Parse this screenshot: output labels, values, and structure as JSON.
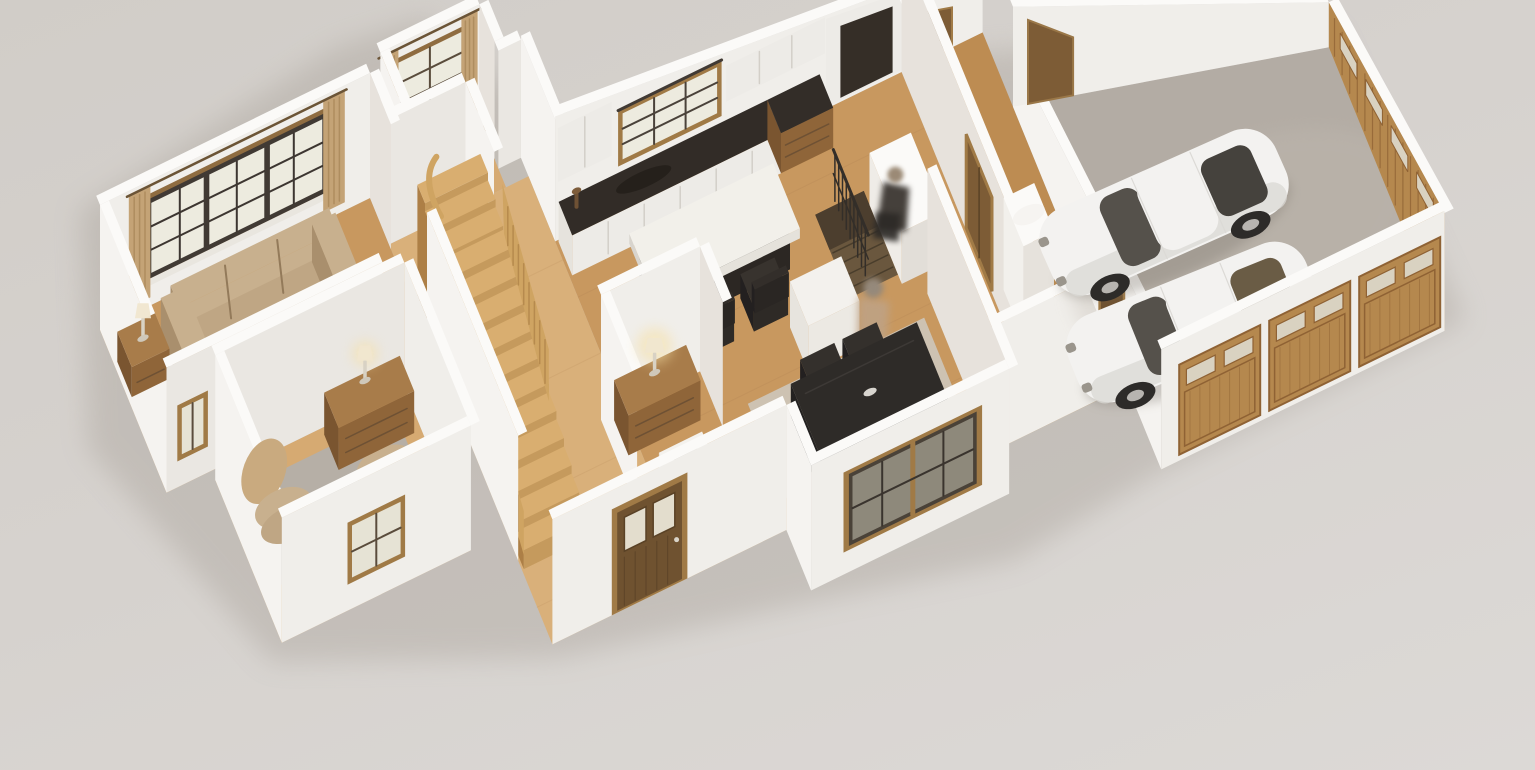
{
  "scene": {
    "description": "3D isometric cutaway floor-plan render of a single-story house model with furnished rooms and an attached two-car garage, viewed from above at an angle on a neutral light-gray ground",
    "view": "isometric dollhouse cutaway, no roof, white cut walls",
    "palette": {
      "ground1": "#d2cec9",
      "ground2": "#dcd9d6",
      "shadow": "#a8a199",
      "wallFace": "#f0eeea",
      "wallBright": "#f5f3f0",
      "wallShade": "#eae7e2",
      "wallInner": "#e7e2dc",
      "wallCap": "#fbfaf8",
      "floorWood": "#c8985f",
      "floorWoodLight": "#d6aa72",
      "floorWoodPale": "#d9b07a",
      "floorWoodDark": "#bd8c52",
      "rug": "#b6afa6",
      "rugWarm": "#cdc6bb",
      "garageFloor": "#b3aca4",
      "garageFloorLight": "#c2bbb2",
      "counterTop": "#322c27",
      "cabinet": "#edebe7",
      "cabinetLine": "#d3cfc8",
      "woodFurn": "#a87c4a",
      "woodFurnFront": "#8f6539",
      "woodFurnSide": "#7a5530",
      "stairTop": "#d9ae70",
      "stairRiser": "#c59a5d",
      "stairSide": "#ad7f46",
      "balustrade": "#cfa462",
      "balusterLine": "#b68a4e",
      "sofa": "#c8b08e",
      "sofaSeat": "#bfa684",
      "sofaShade": "#a98f6d",
      "sofaLine": "#937a5a",
      "curtain": "#c4a376",
      "curtainShade": "#a9875a",
      "curtainRod": "#6b5436",
      "frameDark": "#413a34",
      "frameWood": "#8f6c40",
      "frameWoodLight": "#a07a46",
      "glass": "#edebdf",
      "glassPane": "#e6e3d5",
      "glassDark": "#8e897b",
      "doorBrown": "#6f5230",
      "doorBrown2": "#7d5c36",
      "doorGlass": "#e3ddcd",
      "garageDoor": "#b5884e",
      "garageDoorLine": "#8f6234",
      "garageDoorGlass": "#d9d2c1",
      "tableBlack": "#2e2b28",
      "tableBlackSide": "#201e1c",
      "carBody": "#f3f2f0",
      "carShade": "#dad8d4",
      "carGlass": "#55514b",
      "carWheel": "#2d2b29",
      "carHub": "#b7b4b0",
      "carSunroof2": "#6a5c45",
      "donut": "#ecc99c",
      "donutShade": "#d6b07c",
      "donutHole": "#bb9260",
      "lampGlow": "#f6e0a6",
      "lampShade": "#f0e6cf",
      "lampBase": "#d8d2c4",
      "figureDark": "#45403b",
      "figureHead": "#9b8a76",
      "figureTan": "#bfa284",
      "railDark": "#332e29",
      "voidWood": "#6a573e",
      "voidDark": "#473a2b"
    },
    "rooms": [
      {
        "id": "living-room",
        "label": "Living room",
        "furniture": [
          "beige three-seat sofa",
          "round cream donut ottoman",
          "gray area rug",
          "wooden side table with lamp",
          "wide window with dark sash and tan curtains",
          "small two-pane side window"
        ]
      },
      {
        "id": "breakfast-nook",
        "label": "Breakfast nook",
        "furniture": [
          "round wooden pedestal table",
          "upholstered chair",
          "six-pane window with tan curtains"
        ]
      },
      {
        "id": "kitchen",
        "label": "Kitchen",
        "furniture": [
          "white upper and lower cabinets",
          "dark stone countertop",
          "nine-pane window",
          "wooden drawer unit",
          "dark pantry opening",
          "white-top island table with dark chairs",
          "white storage cube"
        ]
      },
      {
        "id": "stair-hall",
        "label": "Stair hall",
        "furniture": [
          "curved oak staircase with wooden balustrade",
          "console table with lit lamp",
          "white display pedestal",
          "glazed front entry door"
        ]
      },
      {
        "id": "study",
        "label": "Study",
        "furniture": [
          "tan armchair",
          "two stacked round poufs",
          "wooden dresser with lit lamp",
          "four-pane front window"
        ]
      },
      {
        "id": "dining-room",
        "label": "Dining room",
        "furniture": [
          "black dining table with dark chairs",
          "eight-pane front window",
          "blurred standing figure"
        ]
      },
      {
        "id": "basement-stair",
        "label": "Basement stair opening",
        "furniture": [
          "dark railing with balusters",
          "white pony-wall desk",
          "blurred seated figure"
        ]
      },
      {
        "id": "mudroom",
        "label": "Mudroom hallway",
        "furniture": [
          "white water heater",
          "interior wooden doors"
        ]
      },
      {
        "id": "garage",
        "label": "Two-car garage",
        "furniture": [
          "gray concrete floor",
          "wooden side garage-door panel with small windows",
          "three wooden carriage garage doors",
          "brown service doors"
        ]
      }
    ],
    "vehicles": [
      {
        "id": "car-1",
        "label": "white sports coupe, upper bay"
      },
      {
        "id": "car-2",
        "label": "white sports coupe with tinted tan sunroof, lower bay"
      }
    ],
    "counts": {
      "rooms": 9,
      "cars": 2,
      "front_garage_doors": 3,
      "figures": 2,
      "lit_lamps": 2
    }
  }
}
